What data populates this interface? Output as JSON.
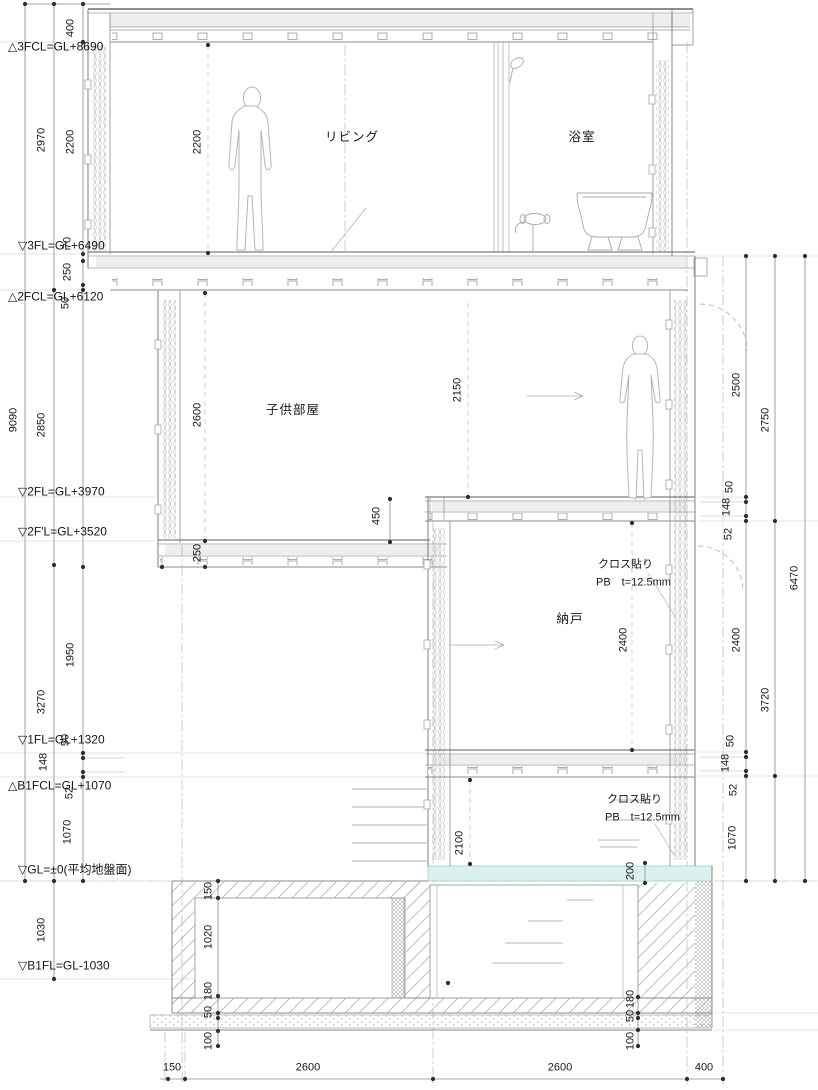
{
  "drawing": {
    "type": "architectural-section",
    "colors": {
      "line": "#9a9a9a",
      "slab": "#7d7d7d",
      "dim_line": "#8a8a8a",
      "dot": "#2e2e2e",
      "text": "#161616",
      "water": "#d9f1ef",
      "hatch": "#c4c4c4"
    },
    "levels": [
      {
        "name": "level-3fcl",
        "text": "△3FCL=GL+8690",
        "x": 8,
        "y": 47
      },
      {
        "name": "level-3fl",
        "text": "▽3FL=GL+6490",
        "x": 18,
        "y": 246
      },
      {
        "name": "level-2fcl",
        "text": "△2FCL=GL+6120",
        "x": 8,
        "y": 297
      },
      {
        "name": "level-2fl",
        "text": "▽2FL=GL+3970",
        "x": 18,
        "y": 492
      },
      {
        "name": "level-2f-dash-l",
        "text": "▽2F'L=GL+3520",
        "x": 18,
        "y": 532
      },
      {
        "name": "level-1fl",
        "text": "▽1FL=GL+1320",
        "x": 18,
        "y": 740
      },
      {
        "name": "level-b1fcl",
        "text": "△B1FCL=GL+1070",
        "x": 8,
        "y": 786
      },
      {
        "name": "level-gl",
        "text": "▽GL=±0(平均地盤面)",
        "x": 18,
        "y": 870
      },
      {
        "name": "level-b1fl",
        "text": "▽B1FL=GL-1030",
        "x": 18,
        "y": 966
      }
    ],
    "vdims": [
      {
        "text": "9090",
        "x": 14,
        "y": 420
      },
      {
        "text": "2970",
        "x": 42,
        "y": 140
      },
      {
        "text": "2850",
        "x": 42,
        "y": 425
      },
      {
        "text": "3270",
        "x": 42,
        "y": 702
      },
      {
        "text": "1030",
        "x": 42,
        "y": 930
      },
      {
        "text": "400",
        "x": 71,
        "y": 28
      },
      {
        "text": "2200",
        "x": 71,
        "y": 142
      },
      {
        "text": "70",
        "x": 68,
        "y": 243
      },
      {
        "text": "250",
        "x": 68,
        "y": 272
      },
      {
        "text": "50",
        "x": 66,
        "y": 303
      },
      {
        "text": "1950",
        "x": 71,
        "y": 655
      },
      {
        "text": "50",
        "x": 66,
        "y": 740
      },
      {
        "text": "148",
        "x": 44,
        "y": 762
      },
      {
        "text": "52",
        "x": 70,
        "y": 793
      },
      {
        "text": "1070",
        "x": 68,
        "y": 832
      },
      {
        "text": "2200",
        "x": 198,
        "y": 142
      },
      {
        "text": "2600",
        "x": 198,
        "y": 415
      },
      {
        "text": "250",
        "x": 198,
        "y": 553
      },
      {
        "text": "450",
        "x": 377,
        "y": 516
      },
      {
        "text": "2150",
        "x": 458,
        "y": 390
      },
      {
        "text": "2400",
        "x": 624,
        "y": 640
      },
      {
        "text": "2100",
        "x": 460,
        "y": 843
      },
      {
        "text": "200",
        "x": 631,
        "y": 871
      },
      {
        "text": "150",
        "x": 209,
        "y": 891
      },
      {
        "text": "1020",
        "x": 209,
        "y": 937
      },
      {
        "text": "180",
        "x": 209,
        "y": 991
      },
      {
        "text": "50",
        "x": 209,
        "y": 1012
      },
      {
        "text": "100",
        "x": 209,
        "y": 1041
      },
      {
        "text": "180",
        "x": 631,
        "y": 999
      },
      {
        "text": "50",
        "x": 631,
        "y": 1016
      },
      {
        "text": "100",
        "x": 631,
        "y": 1041
      },
      {
        "text": "2500",
        "x": 737,
        "y": 385
      },
      {
        "text": "2750",
        "x": 766,
        "y": 420
      },
      {
        "text": "6470",
        "x": 795,
        "y": 578
      },
      {
        "text": "50",
        "x": 730,
        "y": 487
      },
      {
        "text": "148",
        "x": 727,
        "y": 507
      },
      {
        "text": "52",
        "x": 729,
        "y": 534
      },
      {
        "text": "2400",
        "x": 737,
        "y": 640
      },
      {
        "text": "3720",
        "x": 766,
        "y": 700
      },
      {
        "text": "50",
        "x": 731,
        "y": 741
      },
      {
        "text": "148",
        "x": 726,
        "y": 763
      },
      {
        "text": "52",
        "x": 734,
        "y": 790
      },
      {
        "text": "1070",
        "x": 733,
        "y": 838
      }
    ],
    "hdims": [
      {
        "text": "150",
        "x": 172,
        "y": 1068
      },
      {
        "text": "2600",
        "x": 308,
        "y": 1068
      },
      {
        "text": "2600",
        "x": 560,
        "y": 1068
      },
      {
        "text": "400",
        "x": 704,
        "y": 1068
      }
    ],
    "rooms": [
      {
        "name": "room-label-living",
        "text": "リビング",
        "x": 352,
        "y": 137
      },
      {
        "name": "room-label-bathroom",
        "text": "浴室",
        "x": 582,
        "y": 137
      },
      {
        "name": "room-label-kids-room",
        "text": "子供部屋",
        "x": 293,
        "y": 410
      },
      {
        "name": "room-label-storage",
        "text": "納戸",
        "x": 570,
        "y": 619
      }
    ],
    "notes": [
      {
        "name": "finish-note-1-line-1",
        "text": "クロス貼り",
        "x": 598,
        "y": 565
      },
      {
        "name": "finish-note-1-line-2",
        "text": "PB　t=12.5mm",
        "x": 596,
        "y": 583
      },
      {
        "name": "finish-note-2-line-1",
        "text": "クロス貼り",
        "x": 607,
        "y": 800
      },
      {
        "name": "finish-note-2-line-2",
        "text": "PB　t=12.5mm",
        "x": 605,
        "y": 818
      }
    ]
  }
}
